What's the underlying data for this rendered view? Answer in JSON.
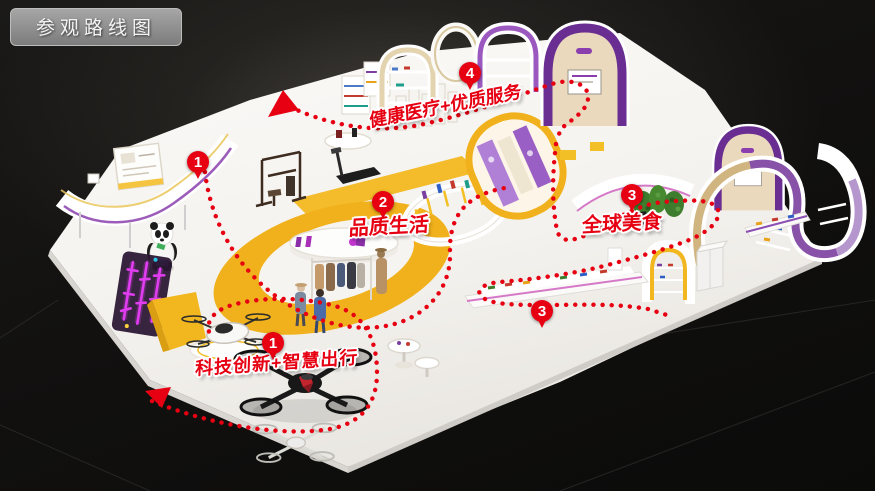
{
  "header": {
    "title": "参观路线图"
  },
  "colors": {
    "route_red": "#e60012",
    "accent_yellow": "#f0b11c",
    "accent_purple": "#6a2d91",
    "neon_magenta": "#e03df0",
    "platform_white": "#f7f5f2",
    "background_dark": "#141311",
    "badge_gray": "#8f8f8f"
  },
  "route": {
    "stops": {
      "stop1_top": "1",
      "stop1_bottom": "1",
      "stop2": "2",
      "stop3_upper": "3",
      "stop3_lower": "3",
      "stop4": "4"
    },
    "zone_labels": {
      "health": "健康医疗+优质服务",
      "life": "品质生活",
      "food": "全球美食",
      "tech": "科技创新+智慧出行"
    }
  }
}
